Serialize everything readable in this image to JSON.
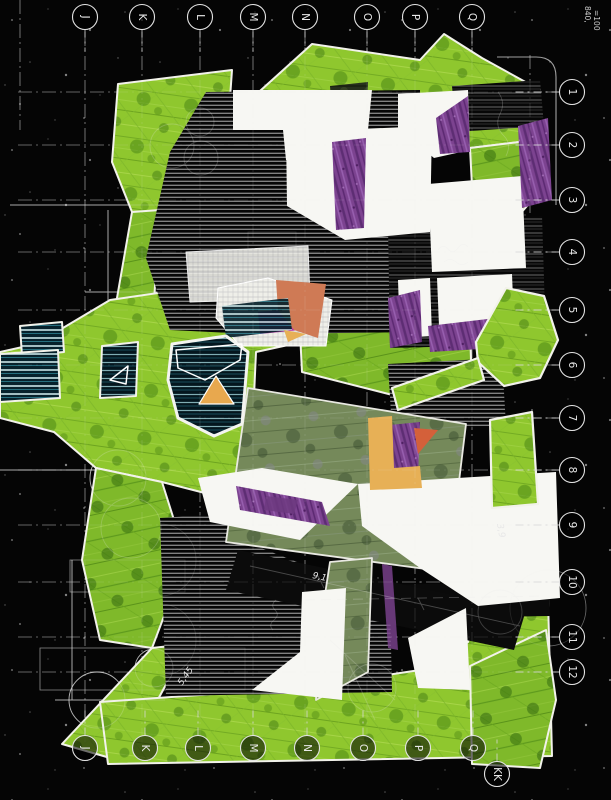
{
  "artwork": {
    "kind": "architectural-plan-collage",
    "description": "Black scanned CAD site plan overlaid with green leaf-texture collage polygons, white cutouts, hatched black blocks, purple, teal and orange fragments",
    "background": "#050505",
    "palette": {
      "cad_line": "#e9e9e9",
      "leaf_bright": "#8fc72e",
      "leaf_dark": "#3c7a10",
      "olive": "#75895a",
      "purple": "#7c4390",
      "teal_dark": "#07222c",
      "teal_light": "#d4f0f2",
      "orange_tan": "#e7b056",
      "orange_red": "#d4603a",
      "salmon": "#cf7a55",
      "magenta": "#b0139a",
      "white_cutout": "#f7f7f3"
    }
  },
  "grid": {
    "bubble_radius": 12.5,
    "top": {
      "y": 17,
      "items": [
        {
          "label": "J",
          "x": 85
        },
        {
          "label": "K",
          "x": 142
        },
        {
          "label": "L",
          "x": 200
        },
        {
          "label": "M",
          "x": 253
        },
        {
          "label": "N",
          "x": 305
        },
        {
          "label": "O",
          "x": 367
        },
        {
          "label": "P",
          "x": 415
        },
        {
          "label": "Q",
          "x": 472
        }
      ]
    },
    "right": {
      "x": 572,
      "items": [
        {
          "label": "1",
          "y": 92
        },
        {
          "label": "2",
          "y": 145
        },
        {
          "label": "3",
          "y": 200
        },
        {
          "label": "4",
          "y": 252
        },
        {
          "label": "5",
          "y": 310
        },
        {
          "label": "6",
          "y": 365
        },
        {
          "label": "7",
          "y": 418
        },
        {
          "label": "8",
          "y": 470
        },
        {
          "label": "9",
          "y": 525
        },
        {
          "label": "10",
          "y": 582
        },
        {
          "label": "11",
          "y": 637
        },
        {
          "label": "12",
          "y": 672
        }
      ]
    },
    "bottom": {
      "y": 748,
      "items": [
        {
          "label": "J",
          "x": 85
        },
        {
          "label": "K",
          "x": 145
        },
        {
          "label": "L",
          "x": 198
        },
        {
          "label": "M",
          "x": 253
        },
        {
          "label": "N",
          "x": 307
        },
        {
          "label": "O",
          "x": 363
        },
        {
          "label": "P",
          "x": 418
        },
        {
          "label": "Q",
          "x": 473
        }
      ]
    },
    "corner": {
      "label": "KK",
      "x": 497,
      "y": 774
    }
  },
  "notes": {
    "top_right_vertical": [
      {
        "text": "840,",
        "x": 585,
        "y": 6
      },
      {
        "text": "=100",
        "x": 594,
        "y": 10
      }
    ],
    "annotations": [
      {
        "text": "5,45",
        "x": 182,
        "y": 686,
        "rot": -55
      },
      {
        "text": "3,9",
        "x": 497,
        "y": 524,
        "rot": 80
      },
      {
        "text": "9,1",
        "x": 312,
        "y": 578,
        "rot": 12
      }
    ]
  }
}
